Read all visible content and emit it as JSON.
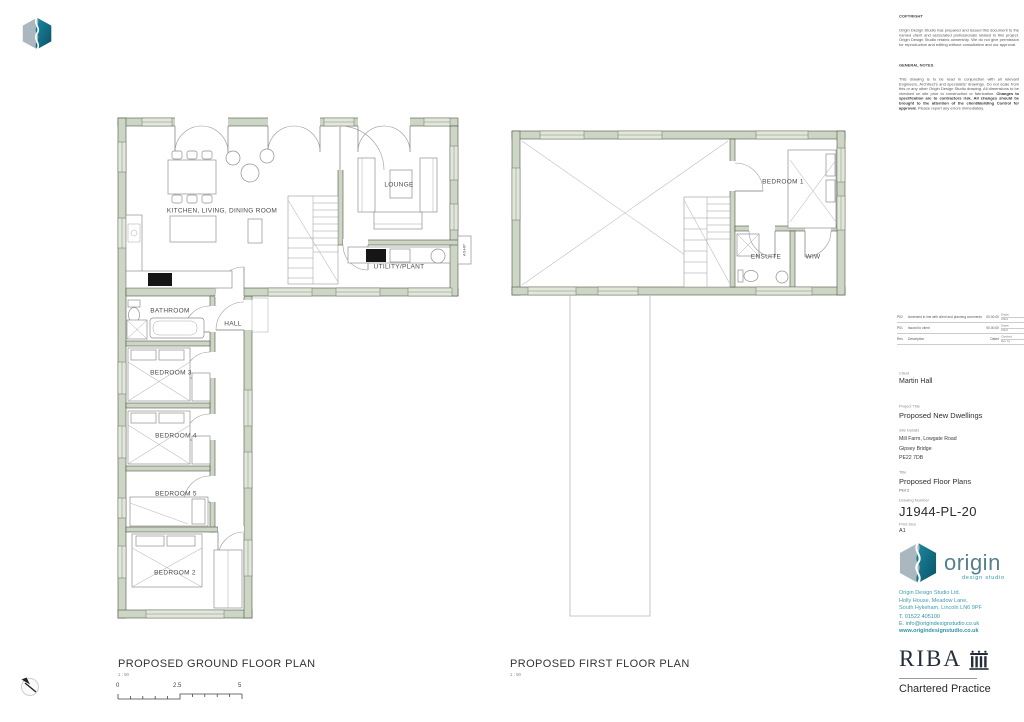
{
  "notes": {
    "copyright_title": "COPYRIGHT",
    "copyright_body": "Origin Design Studio has prepared and issued this document to the named client and associated professionals related to this project. Origin Design Studio retains ownership. We do not give permission for reproduction and editing without consultation and our approval.",
    "general_title": "GENERAL NOTES",
    "general_body_1": "This drawing is to be read in conjunction with all relevant Engineers, Architect's and specialists' drawings. Do not scale from this or any other Origin Design Studio drawing. All dimensions to be checked on site prior to construction or fabrication. ",
    "general_body_bold": "Changes to specification are to contractors risk. All changes should be brought to the attention of the client/Building Control for approval.",
    "general_body_2": " Please report any errors immediately."
  },
  "revisions": {
    "rows": [
      {
        "code": "P02",
        "desc": "Amended in line with client and planning comments",
        "date": "00.00.00",
        "by": "Drawn",
        "chk": "Chk'd"
      },
      {
        "code": "P01",
        "desc": "Issued to client",
        "date": "00.00.00",
        "by": "Drawn",
        "chk": "Chk'd"
      },
      {
        "code": "Rev.",
        "desc": "Description",
        "date": "Dated",
        "by": "Checked",
        "chk": "Rev. by"
      }
    ]
  },
  "title_block": {
    "client_label": "Client",
    "client": "Martin Hall",
    "project_label": "Project Title",
    "project": "Proposed New Dwellings",
    "site_label": "Site Details",
    "site_line1": "Mill Farm, Lowgate Road",
    "site_line2": "Gipsey Bridge",
    "site_line3": "PE22 7DB",
    "title_label": "Title",
    "title": "Proposed Floor Plans",
    "plot": "Plot 2",
    "number_label": "Drawing Number",
    "number": "J1944-PL-20",
    "size_label": "Print Size",
    "size": "A1"
  },
  "branding": {
    "wordmark": "origin",
    "tagline": "design studio",
    "company": "Origin Design Studio Ltd.",
    "address1": "Holly House, Meadow Lane,",
    "address2": "South Hykeham, Lincoln LN6 9PF",
    "phone": "T. 01522 405100",
    "email": "E. info@origindesignstudio.co.uk",
    "website": "www.origindesignstudio.co.uk",
    "riba": "RIBA",
    "riba_sub": "Chartered Practice"
  },
  "plans": {
    "ground": {
      "title": "PROPOSED GROUND FLOOR PLAN",
      "scale": "1 : 50",
      "rooms": {
        "kitchen": "KITCHEN, LIVING, DINING ROOM",
        "lounge": "LOUNGE",
        "utility": "UTILITY/PLANT",
        "bathroom": "BATHROOM",
        "hall": "HALL",
        "bedroom3": "BEDROOM 3",
        "bedroom4": "BEDROOM 4",
        "bedroom5": "BEDROOM 5",
        "bedroom2": "BEDROOM 2",
        "ashp": "ASHP"
      }
    },
    "first": {
      "title": "PROPOSED FIRST FLOOR PLAN",
      "scale": "1 : 50",
      "rooms": {
        "bedroom1": "BEDROOM 1",
        "ensuite": "ENSUITE",
        "wiw": "WIW"
      }
    }
  },
  "scale_bar": {
    "t0": "0",
    "t1": "2.5",
    "t2": "5"
  },
  "colors": {
    "wall": "#cdd6c4",
    "window": "#e1e8da",
    "teal": "#2d96aa",
    "teal_dark": "#0e6e84",
    "riba_navy": "#242e3a"
  }
}
